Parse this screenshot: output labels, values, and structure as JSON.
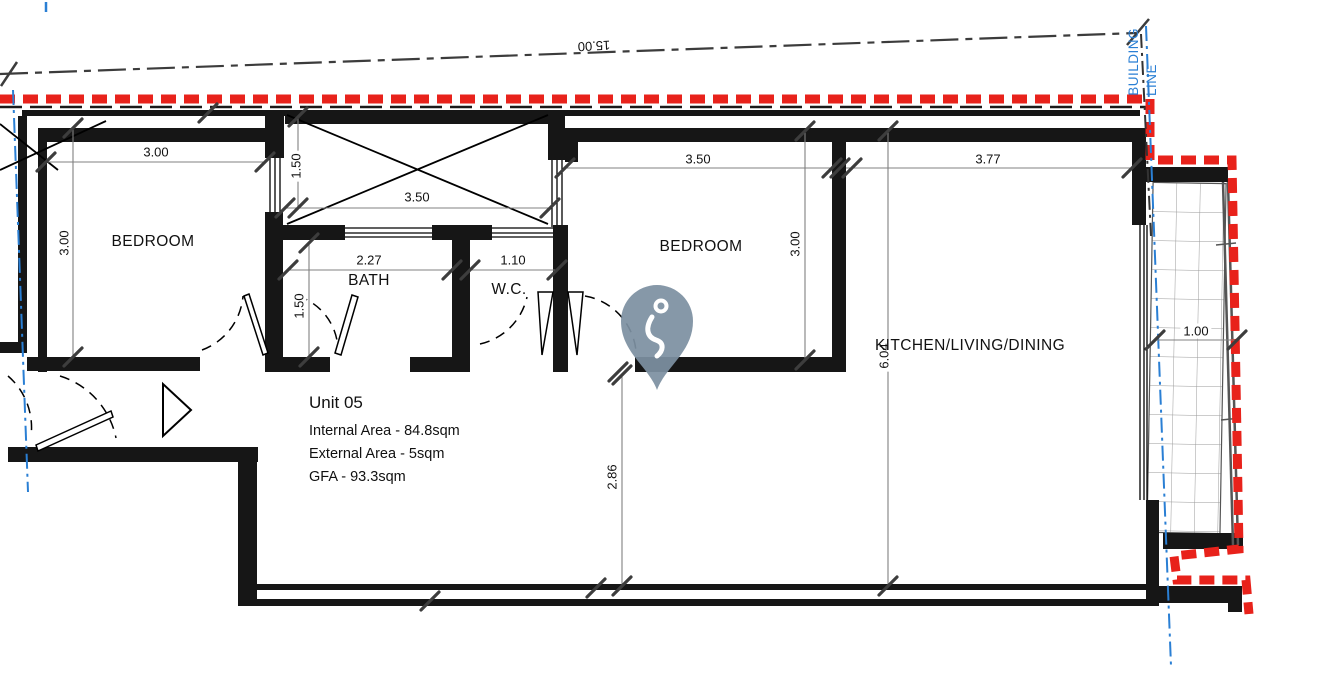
{
  "colors": {
    "boundary_red": "#e8221b",
    "building_line_blue": "#2a7fd4",
    "wall_black": "#161616",
    "pin_fill": "#7d90a1"
  },
  "site": {
    "boundary_length": "15.00",
    "building_line_word1": "BUILDING",
    "building_line_word2": "LINE"
  },
  "rooms": {
    "bedroom1": "BEDROOM",
    "bedroom2": "BEDROOM",
    "bath": "BATH",
    "wc": "W.C.",
    "kitchen": "KITCHEN/LIVING/DINING"
  },
  "dimensions": {
    "bedroom1_width": "3.00",
    "bedroom1_depth": "3.00",
    "shaft_window_height": "1.50",
    "shaft_width": "3.50",
    "bath_width": "2.27",
    "wc_width": "1.10",
    "bath_depth": "1.50",
    "bedroom2_width": "3.50",
    "bedroom2_depth": "3.00",
    "kitchen_width": "3.77",
    "kitchen_depth": "6.04",
    "hall_depth": "2.86",
    "balcony_width": "1.00"
  },
  "unit": {
    "title": "Unit 05",
    "internal_area": "Internal Area - 84.8sqm",
    "external_area": "External Area - 5sqm",
    "gfa": "GFA - 93.3sqm"
  }
}
